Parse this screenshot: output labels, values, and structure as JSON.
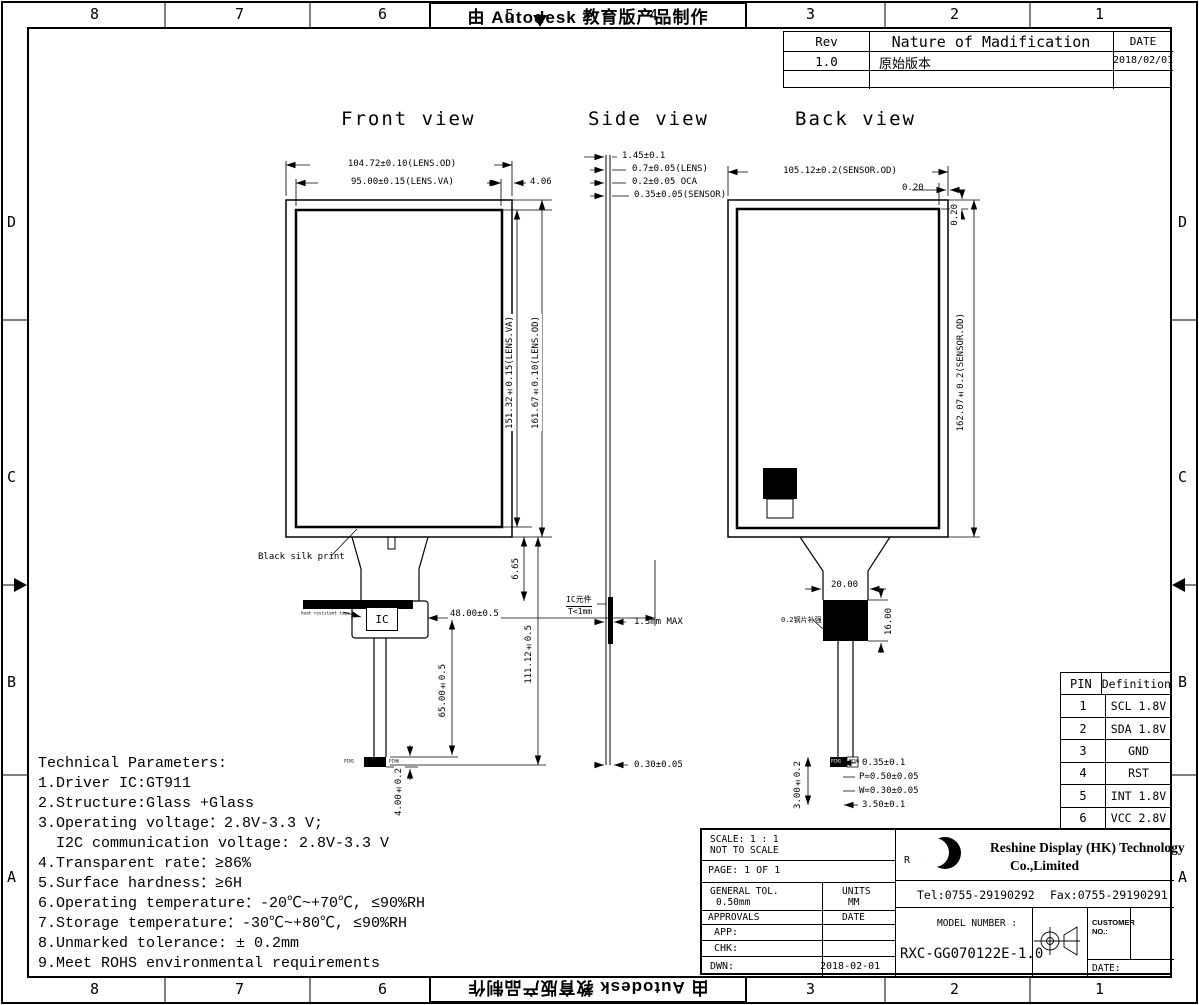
{
  "banner": {
    "text": "由 Autodesk 教育版产品制作"
  },
  "zones": {
    "cols": [
      "8",
      "7",
      "6",
      "5",
      "4",
      "3",
      "2",
      "1"
    ],
    "rows": [
      "D",
      "C",
      "B",
      "A"
    ]
  },
  "revision_table": {
    "headers": [
      "Rev",
      "Nature of Madification",
      "DATE"
    ],
    "rows": [
      [
        "1.0",
        "原始版本",
        "2018/02/01"
      ],
      [
        "",
        "",
        ""
      ]
    ]
  },
  "front": {
    "title": "Front view",
    "dim_lens_od_width": "104.72±0.10(LENS.OD)",
    "dim_lens_va_width": "95.00±0.15(LENS.VA)",
    "dim_edge": "4.06",
    "dim_lens_va_height": "151.32±0.15(LENS.VA)",
    "dim_lens_od_height": "161.67±0.10(LENS.OD)",
    "black_silk_label": "Black silk print",
    "tape_label": "heat resistant tape",
    "ic_label": "IC",
    "dim_fpc_offset": "48.00±0.5",
    "dim_tail_top": "6.65",
    "dim_fpc_length": "111.12±0.5",
    "dim_fpc_mid": "65.00±0.5",
    "dim_connector": "4.00±0.2",
    "pin1_label": "PIN1",
    "pin6_label": "PIN6"
  },
  "side": {
    "title": "Side view",
    "dim_total": "1.45±0.1",
    "dim_lens": "0.7±0.05(LENS)",
    "dim_oca": "0.2±0.05 OCA",
    "dim_sensor": "0.35±0.05(SENSOR)",
    "ic_note_line1": "IC元件",
    "ic_note_line2": "T<1mm",
    "dim_ic": "1.3mm MAX",
    "dim_tail": "0.30±0.05"
  },
  "back": {
    "title": "Back view",
    "dim_sensor_od_width": "105.12±0.2(SENSOR.OD)",
    "dim_top_edge": "0.20",
    "dim_right_edge": "0.20",
    "dim_sensor_od_height": "162.07±0.2(SENSOR.OD)",
    "dim_stiffener_width": "20.00",
    "dim_stiffener_height": "16.00",
    "stiffener_label": "0.2钢片补强",
    "dim_connector_edge": "0.35±0.1",
    "dim_pitch": "P=0.50±0.05",
    "dim_trace_width": "W=0.30±0.05",
    "dim_connector_width": "3.50±0.1",
    "dim_connector_height": "3.00±0.2",
    "pin1_label": "PIN1",
    "pin6_label": "PIN6"
  },
  "tech": {
    "title": "Technical Parameters:",
    "lines": [
      "1.Driver IC:GT911",
      "2.Structure:Glass +Glass",
      "3.Operating voltage：2.8V-3.3 V;",
      "  I2C communication voltage: 2.8V-3.3 V",
      "4.Transparent rate：≥86%",
      "5.Surface hardness：≥6H",
      "6.Operating temperature：-20℃~+70℃, ≤90%RH",
      "7.Storage temperature：-30℃~+80℃, ≤90%RH",
      "8.Unmarked tolerance: ± 0.2mm",
      "9.Meet ROHS environmental requirements"
    ]
  },
  "pin_table": {
    "headers": [
      "PIN",
      "Definition"
    ],
    "rows": [
      [
        "1",
        "SCL 1.8V"
      ],
      [
        "2",
        "SDA 1.8V"
      ],
      [
        "3",
        "GND"
      ],
      [
        "4",
        "RST"
      ],
      [
        "5",
        "INT 1.8V"
      ],
      [
        "6",
        "VCC 2.8V"
      ]
    ]
  },
  "title_block": {
    "scale_label": "SCALE: 1 : 1",
    "scale_note": "NOT TO SCALE",
    "page": "PAGE: 1 OF 1",
    "general_tol_label": "GENERAL TOL.",
    "general_tol_value": "0.50mm",
    "units_label": "UNITS",
    "units_value": "MM",
    "approvals_label": "APPROVALS",
    "date_label": "DATE",
    "app_label": "APP:",
    "chk_label": "CHK:",
    "dwn_label": "DWN:",
    "dwn_date": "2018-02-01",
    "logo_text": "R X",
    "company_line1": "Reshine Display (HK) Technology",
    "company_line2": "Co.,Limited",
    "tel": "Tel:0755-29190292",
    "fax": "Fax:0755-29190291",
    "model_label": "MODEL NUMBER :",
    "model_number": "RXC-GG070122E-1.0",
    "customer_label_line1": "CUSTOMER",
    "customer_label_line2": "NO.:",
    "customer_date_label": "DATE:"
  }
}
